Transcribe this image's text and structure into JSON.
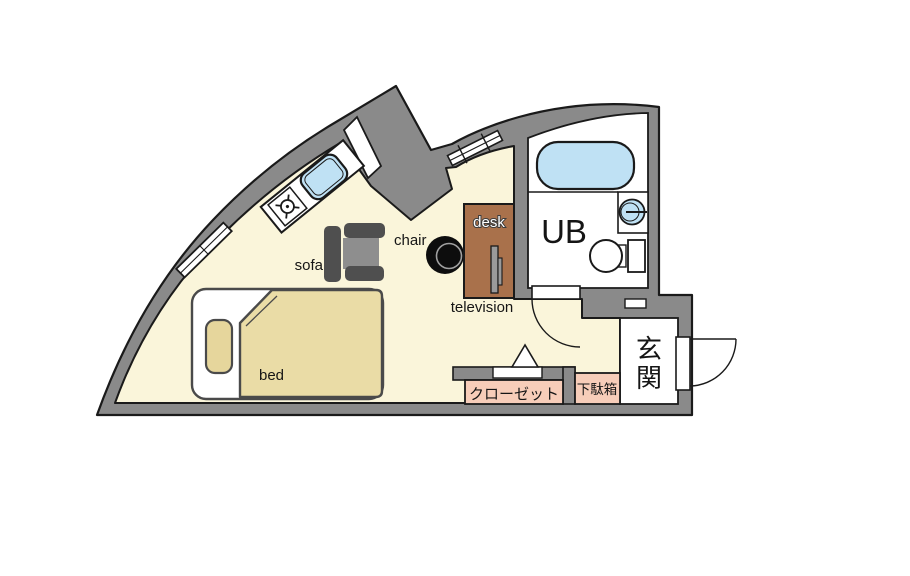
{
  "document": {
    "type": "floor-plan",
    "description": "Japanese studio apartment floor plan with curved outer wall, unit bath and entrance"
  },
  "labels": {
    "sofa": "sofa",
    "chair": "chair",
    "desk": "desk",
    "television": "television",
    "bed": "bed",
    "unit_bath": "UB",
    "entrance": "玄関",
    "closet": "クローゼット",
    "shoe_cabinet": "下駄箱"
  },
  "fixtures": [
    "bathtub",
    "washbasin",
    "toilet",
    "kitchen-sink",
    "stove-burner",
    "single-bed",
    "pillow",
    "blanket",
    "sofa",
    "chair",
    "desk",
    "television",
    "closet",
    "shoe-cabinet",
    "entrance-door",
    "bath-door",
    "folding-closet-door",
    "window",
    "balcony-opening",
    "structural-pillar"
  ],
  "colors": {
    "wall": "#8a8a8a",
    "outline": "#1a1a1a",
    "floor": "#faf5da",
    "water": "#bfe1f4",
    "desk_wood": "#a9714b",
    "storage_pink": "#f7cdb9",
    "bedding_tan": "#eadca6",
    "pillow_tan": "#e6d69c",
    "sofa_dark": "#4f4f4f",
    "sofa_seat": "#8e8e8e",
    "tv_gray": "#9a9a9a",
    "chair_black": "#0d0d0d",
    "white": "#ffffff"
  }
}
